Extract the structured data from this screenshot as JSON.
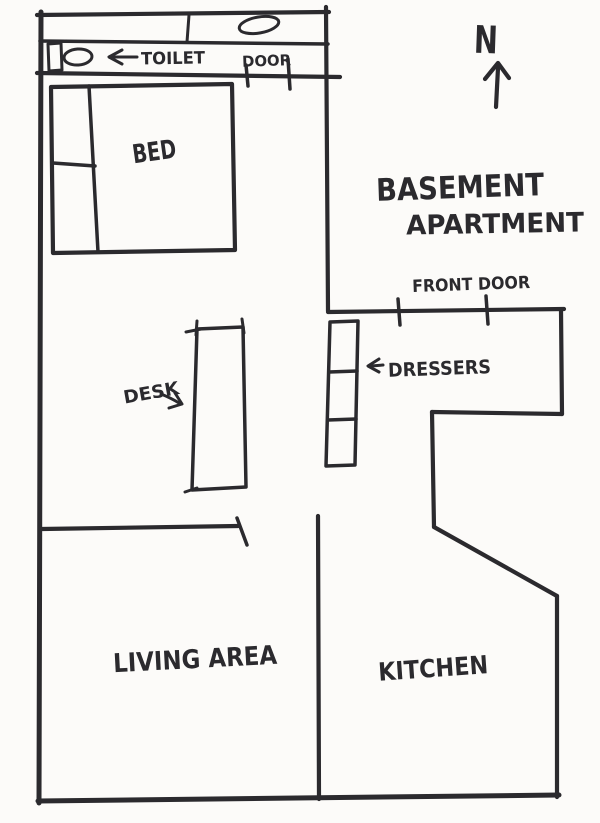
{
  "colors": {
    "ink": "#2b2a2e",
    "paper": "#fcfbf9"
  },
  "title": {
    "line1": "BASEMENT",
    "line2": "APARTMENT"
  },
  "compass": {
    "north": "N"
  },
  "bathroom": {
    "toilet_label": "TOILET",
    "door_label": "DOOR"
  },
  "bedroom": {
    "bed_label": "BED",
    "desk_label": "DESK",
    "dressers_label": "DRESSERS"
  },
  "entry": {
    "front_door_label": "FRONT DOOR"
  },
  "rooms": {
    "living_label": "LIVING AREA",
    "kitchen_label": "KITCHEN"
  }
}
